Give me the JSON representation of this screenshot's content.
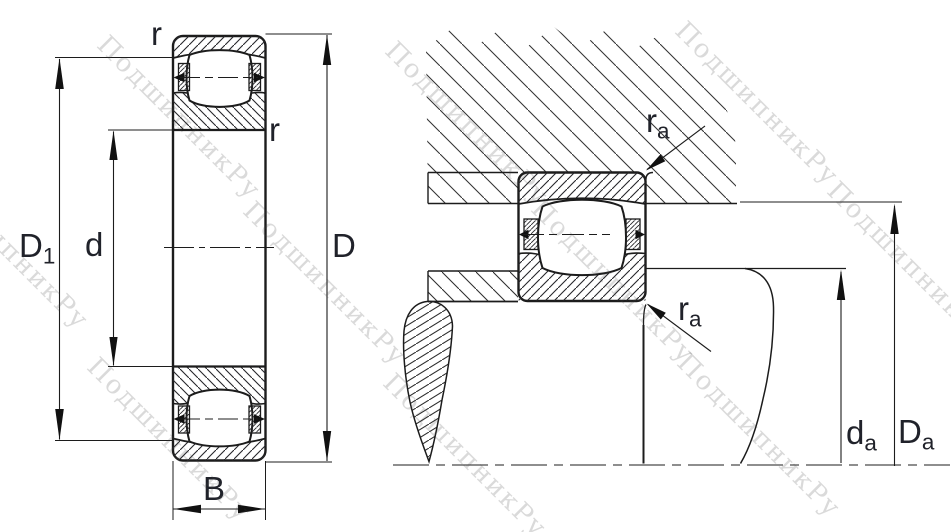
{
  "meta": {
    "description": "Technical dimension drawing of a barrel roller bearing: left view shows bearing cross-section with boundary dimensions, right view shows mounted bearing with abutment dimensions"
  },
  "watermark": {
    "text": "ПодшипникРу"
  },
  "labels": {
    "left_view": {
      "r_top": "r",
      "r_inner": "r",
      "d1_main": "D",
      "d1_sub": "1",
      "d_main": "d",
      "D_main": "D",
      "B_main": "B"
    },
    "right_view": {
      "ra_top_main": "r",
      "ra_top_sub": "a",
      "ra_bottom_main": "r",
      "ra_bottom_sub": "a",
      "da_main": "d",
      "da_sub": "a",
      "Da_main": "D",
      "Da_sub": "a"
    }
  },
  "colors": {
    "line": "#1c1c1c",
    "label": "#20222a",
    "hatch": "#2a2a2a"
  }
}
